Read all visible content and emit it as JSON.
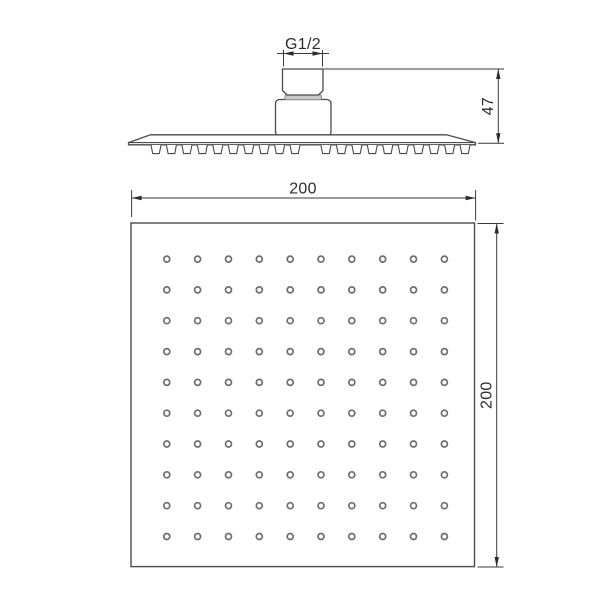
{
  "colors": {
    "background": "#ffffff",
    "outline": "#4a4a4a",
    "dimension_lines": "#3a3a3a",
    "label_text": "#2b2b2b",
    "gasket_fill": "#c9c9c9",
    "nozzle_ring": "#6e6e6e"
  },
  "side_view": {
    "dimensions": {
      "thread_label": "G1/2",
      "height_label": "47"
    },
    "nozzle_profile_count": 20
  },
  "bottom_view": {
    "dimensions": {
      "width_label": "200",
      "height_label": "200"
    },
    "nozzle_grid": {
      "rows": 10,
      "cols": 10
    }
  }
}
